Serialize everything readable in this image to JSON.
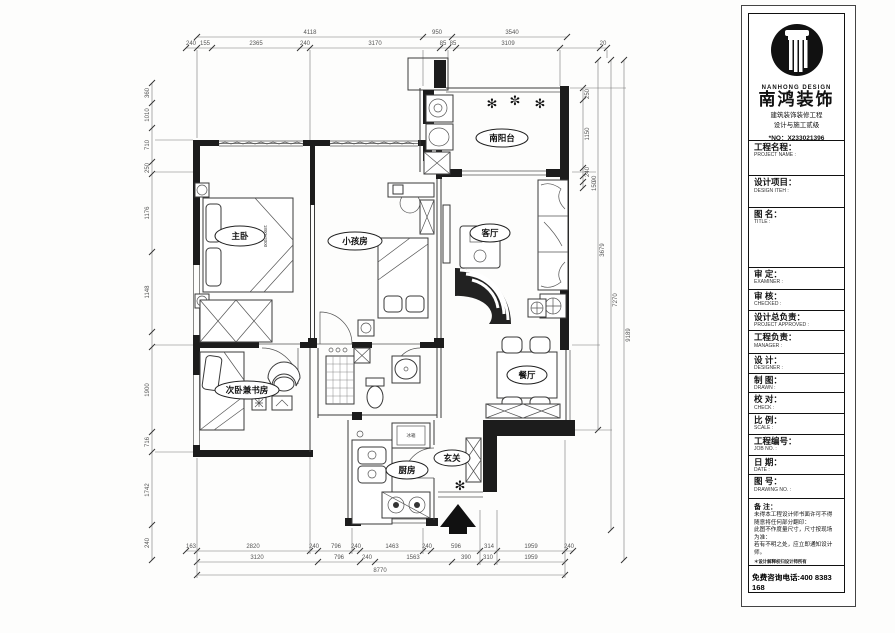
{
  "company": {
    "name_en": "NANHONG DESIGN",
    "name_cn": "南鸿装饰",
    "cert_line1": "建筑装饰装修工程",
    "cert_line2": "设计与施工贰级",
    "cert_no": "*NO：X233021396",
    "phone": "免费咨询电话:400 8383 168"
  },
  "title_block": {
    "rows": [
      {
        "cn": "工程名程：",
        "en": "PROJECT NAME :"
      },
      {
        "cn": "设计项目：",
        "en": "DESIGN ITEH :"
      },
      {
        "cn": "图 名：",
        "en": "TITLE :"
      },
      {
        "cn": "审 定：",
        "en": "EXAMINER :"
      },
      {
        "cn": "审 核：",
        "en": "CHECKED :"
      },
      {
        "cn": "设计总负责：",
        "en": "PROJECT APPROVED :"
      },
      {
        "cn": "工程负责：",
        "en": "MANAGER :"
      },
      {
        "cn": "设 计：",
        "en": "DESIGNER :"
      },
      {
        "cn": "制 图：",
        "en": "DRAWN :"
      },
      {
        "cn": "校 对：",
        "en": "CHECK :"
      },
      {
        "cn": "比 例：",
        "en": "SCALE :"
      },
      {
        "cn": "工程编号：",
        "en": "JOB NO. :"
      },
      {
        "cn": "日 期：",
        "en": "DATE :"
      },
      {
        "cn": "图 号：",
        "en": "DRAWING NO. :"
      }
    ],
    "notes_title": "备 注：",
    "notes": [
      "未得本工程设计师书面许可不得",
      "随意将任何部分翻印：",
      "此图不作度量尺寸，尺寸按现场",
      "为准：",
      "若有不明之处，应立即通知设计",
      "师。"
    ],
    "note_small": "＊设计解释权归设计师所有"
  },
  "plan": {
    "rooms": {
      "master": "主卧",
      "kids": "小孩房",
      "balcony": "南阳台",
      "living": "客厅",
      "dining": "餐厅",
      "entry": "玄关",
      "kitchen": "厨房",
      "study": "次卧兼书房"
    },
    "bed_size": "1800x2000",
    "fridge_label": "冰箱",
    "dims": {
      "top1": [
        "4118",
        "950",
        "3540"
      ],
      "top2": [
        "240",
        "155",
        "2365",
        "240",
        "3170",
        "85",
        "85",
        "3109",
        "20"
      ],
      "bottom1": [
        "163",
        "2820",
        "240",
        "796",
        "240",
        "1463",
        "240",
        "596",
        "314",
        "1959",
        "240"
      ],
      "bottom2": [
        "3120",
        "796",
        "240",
        "1563",
        "390",
        "310",
        "1959"
      ],
      "total": "8770",
      "left": [
        "360",
        "1010",
        "710",
        "250",
        "1176",
        "1148",
        "1900",
        "716",
        "1742",
        "240"
      ],
      "right": [
        "250",
        "1150",
        "240",
        "90",
        "150",
        "3679",
        "7270",
        "9189"
      ]
    }
  }
}
